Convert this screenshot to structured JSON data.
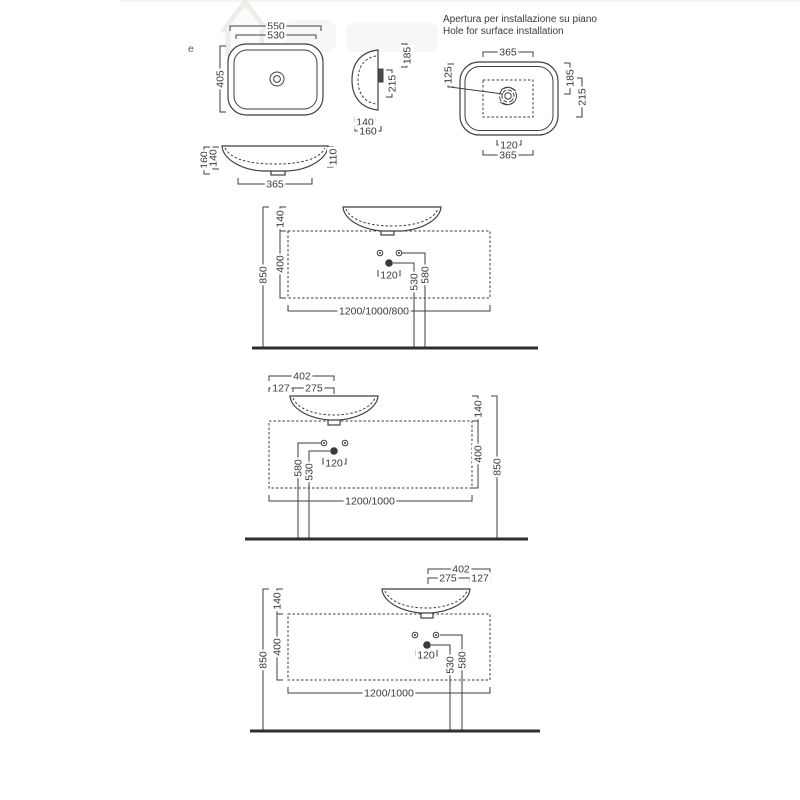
{
  "watermark": {
    "letter": "e"
  },
  "hole_section": {
    "title_line1": "Apertura per installazione su piano",
    "title_line2": "Hole for surface installation",
    "dim_top_width": "365",
    "dim_hole_offset": "125",
    "dim_right_upper": "185",
    "dim_right_lower": "215",
    "dim_bottom_inner": "120",
    "dim_bottom_width": "365"
  },
  "top_view": {
    "dim_outer_width": "550",
    "dim_inner_width": "530",
    "dim_depth": "405"
  },
  "side_view": {
    "dim_height_upper": "185",
    "dim_height_lower": "215",
    "dim_base_inner": "140",
    "dim_base_outer": "160"
  },
  "front_view": {
    "dim_left_outer": "160",
    "dim_left_inner": "140",
    "dim_height_right": "110",
    "dim_base_width": "365"
  },
  "installation_center": {
    "dim_rim_above_top": "140",
    "dim_console_height": "400",
    "dim_total_height": "850",
    "dim_drain_height": "530",
    "dim_faucet_height": "580",
    "dim_drain_offset": "120",
    "dim_console_widths": "1200/1000/800"
  },
  "installation_left": {
    "dim_top": "402",
    "dim_edge": "127",
    "dim_to_drain": "275",
    "dim_rim_above_top": "140",
    "dim_console_height": "400",
    "dim_total_height": "850",
    "dim_faucet_height": "580",
    "dim_drain_height": "530",
    "dim_drain_offset": "120",
    "dim_console_widths": "1200/1000"
  },
  "installation_right": {
    "dim_top": "402",
    "dim_to_drain": "275",
    "dim_edge": "127",
    "dim_rim_above_top": "140",
    "dim_console_height": "400",
    "dim_total_height": "850",
    "dim_faucet_height": "580",
    "dim_drain_height": "530",
    "dim_drain_offset": "120",
    "dim_console_widths": "1200/1000"
  }
}
